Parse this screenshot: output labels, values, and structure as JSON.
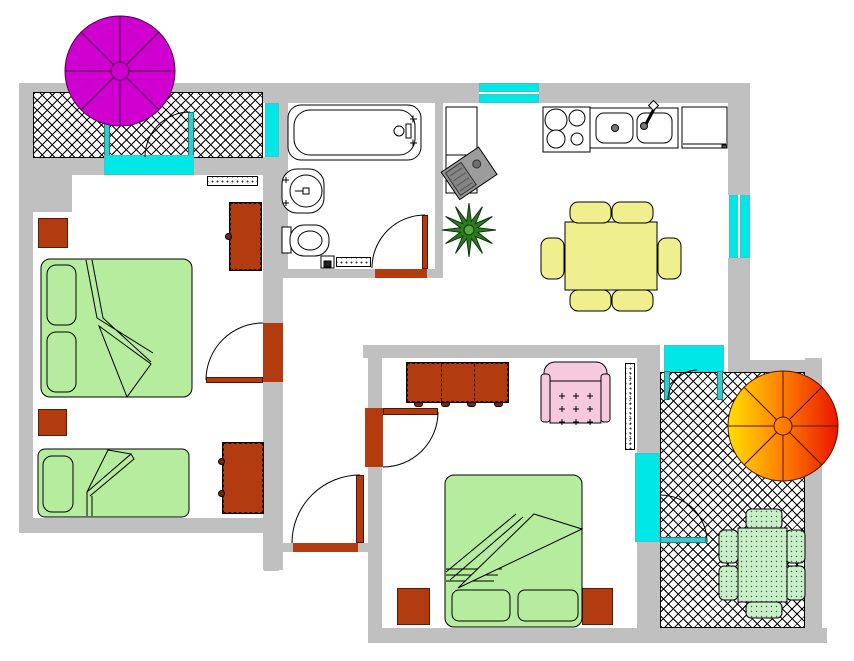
{
  "floor_plan": {
    "colors": {
      "wall": "#c0c0c0",
      "window_cyan": "#00e7e7",
      "frame_teal": "#3fc6c6",
      "door_brown": "#b23b10",
      "knob_dark": "#7d2606",
      "bed_green": "#b6ec9e",
      "dining_yellow": "#efef8d",
      "armchair_pink": "#f7c9df",
      "parasol_magenta": "#cf00cf",
      "parasol_orange_start": "#ffdf00",
      "parasol_orange_mid": "#ff8800",
      "parasol_orange_end": "#ea1500",
      "plant_green": "#2d7a1f",
      "plant_center": "#5aa832",
      "garden_green": "#c9eec9",
      "garden_dot": "#336633",
      "tv_gray": "#9c9c9c"
    },
    "rooms": [
      {
        "id": "balcony-top-left",
        "type": "balcony",
        "features": [
          "crosshatch-floor",
          "parasol-magenta",
          "balcony-door",
          "window"
        ]
      },
      {
        "id": "bedroom-left",
        "type": "bedroom",
        "furniture": [
          "double-bed",
          "single-bed",
          "nightstand",
          "nightstand",
          "wardrobe",
          "dresser",
          "radiator",
          "door"
        ]
      },
      {
        "id": "bathroom",
        "type": "bathroom",
        "furniture": [
          "bathtub",
          "washbasin",
          "toilet",
          "waste-bin",
          "bath-mat",
          "door"
        ]
      },
      {
        "id": "kitchen-dining",
        "type": "kitchen",
        "furniture": [
          "stove",
          "double-sink",
          "refrigerator",
          "cabinet",
          "tv-radio",
          "houseplant",
          "dining-table",
          "six-chairs",
          "window",
          "window"
        ]
      },
      {
        "id": "hallway",
        "type": "hall",
        "features": [
          "entrance-door"
        ]
      },
      {
        "id": "living-bedroom",
        "type": "room",
        "furniture": [
          "sideboard",
          "armchair",
          "radiator",
          "double-bed",
          "nightstand",
          "nightstand",
          "balcony-door",
          "window",
          "door"
        ]
      },
      {
        "id": "balcony-right",
        "type": "balcony",
        "features": [
          "crosshatch-floor",
          "parasol-orange",
          "garden-table",
          "six-garden-chairs",
          "balcony-door"
        ]
      }
    ]
  }
}
